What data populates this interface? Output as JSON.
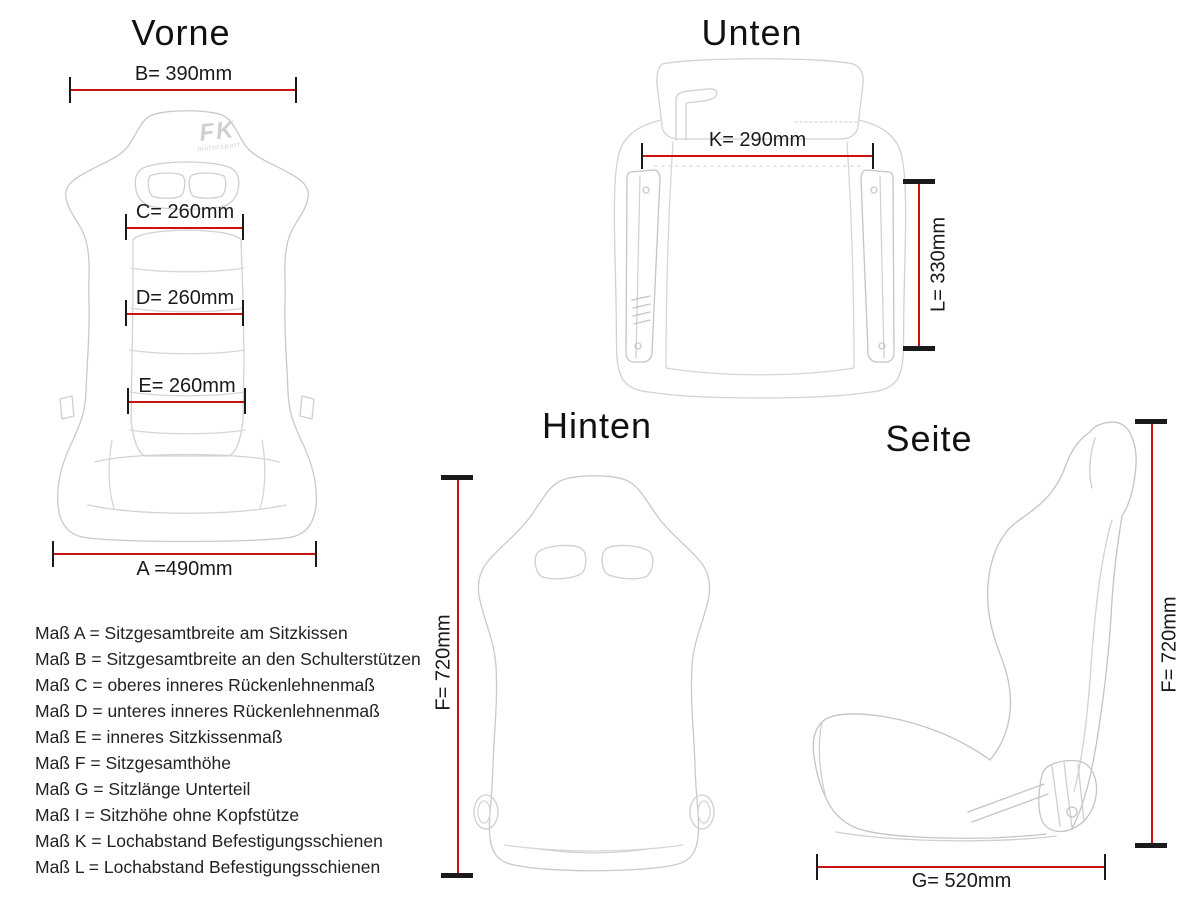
{
  "colors": {
    "background": "#ffffff",
    "dimension_line": "#cc1111",
    "tick": "#1a1a1a",
    "text": "#1a1a1a",
    "drawing_outline": "#c9c9c9"
  },
  "views": {
    "vorne": {
      "title": "Vorne"
    },
    "unten": {
      "title": "Unten"
    },
    "hinten": {
      "title": "Hinten"
    },
    "seite": {
      "title": "Seite"
    }
  },
  "logo": {
    "brand": "FK",
    "sub": "motorsport"
  },
  "dimensions": {
    "B": {
      "label": "B= 390mm"
    },
    "C": {
      "label": "C= 260mm"
    },
    "D": {
      "label": "D= 260mm"
    },
    "E": {
      "label": "E= 260mm"
    },
    "A": {
      "label": "A =490mm"
    },
    "K": {
      "label": "K= 290mm"
    },
    "L": {
      "label": "L= 330mm"
    },
    "F_hinten": {
      "label": "F= 720mm"
    },
    "F_seite": {
      "label": "F= 720mm"
    },
    "G": {
      "label": "G= 520mm"
    }
  },
  "legend": {
    "items": [
      "Maß A = Sitzgesamtbreite am Sitzkissen",
      "Maß B = Sitzgesamtbreite an den Schulterstützen",
      "Maß C = oberes inneres Rückenlehnenmaß",
      "Maß D = unteres inneres Rückenlehnenmaß",
      "Maß E = inneres Sitzkissenmaß",
      "Maß F = Sitzgesamthöhe",
      "Maß G = Sitzlänge Unterteil",
      "Maß I = Sitzhöhe ohne Kopfstütze",
      "Maß K = Lochabstand Befestigungsschienen",
      "Maß L = Lochabstand Befestigungsschienen"
    ]
  }
}
